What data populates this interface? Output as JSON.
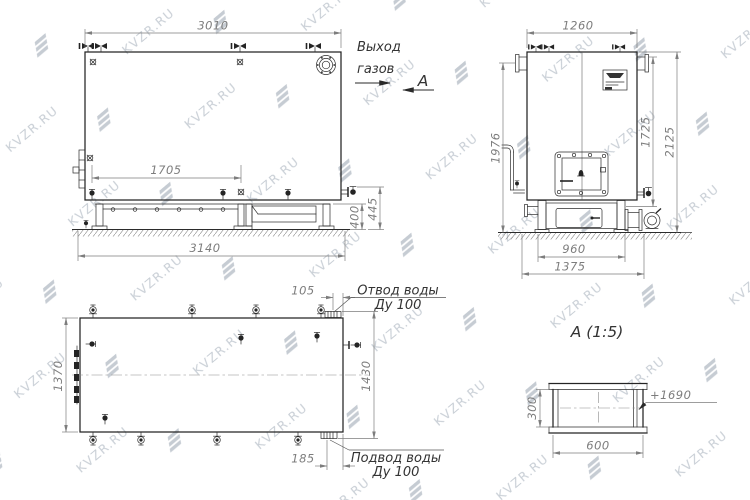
{
  "watermark": {
    "text": "KVZR.RU",
    "color": "#c9cfd6"
  },
  "annotations": {
    "gas_outlet": [
      "Выход",
      "газов"
    ],
    "view_arrow_label": "А",
    "detail_title": "А  (1:5)",
    "water_outlet": [
      "Отвод воды",
      "Ду 100"
    ],
    "water_inlet": [
      "Подвод воды",
      "Ду 100"
    ],
    "elevation_mark": "+1690"
  },
  "dimensions": {
    "side_view": {
      "overall_width": "3010",
      "inner_span": "1705",
      "base_width": "3140",
      "base_height": "400",
      "base_height_outer": "445"
    },
    "front_view": {
      "overall_width": "1260",
      "height_left": "1976",
      "height_right": "1725",
      "overall_height": "2125",
      "base_width": "960",
      "base_width_outer": "1375"
    },
    "plan_view": {
      "width_left": "1370",
      "width_right": "1430",
      "outlet_offset": "105",
      "inlet_offset": "185"
    },
    "detail_view": {
      "duct_height": "300",
      "duct_width": "600"
    }
  }
}
